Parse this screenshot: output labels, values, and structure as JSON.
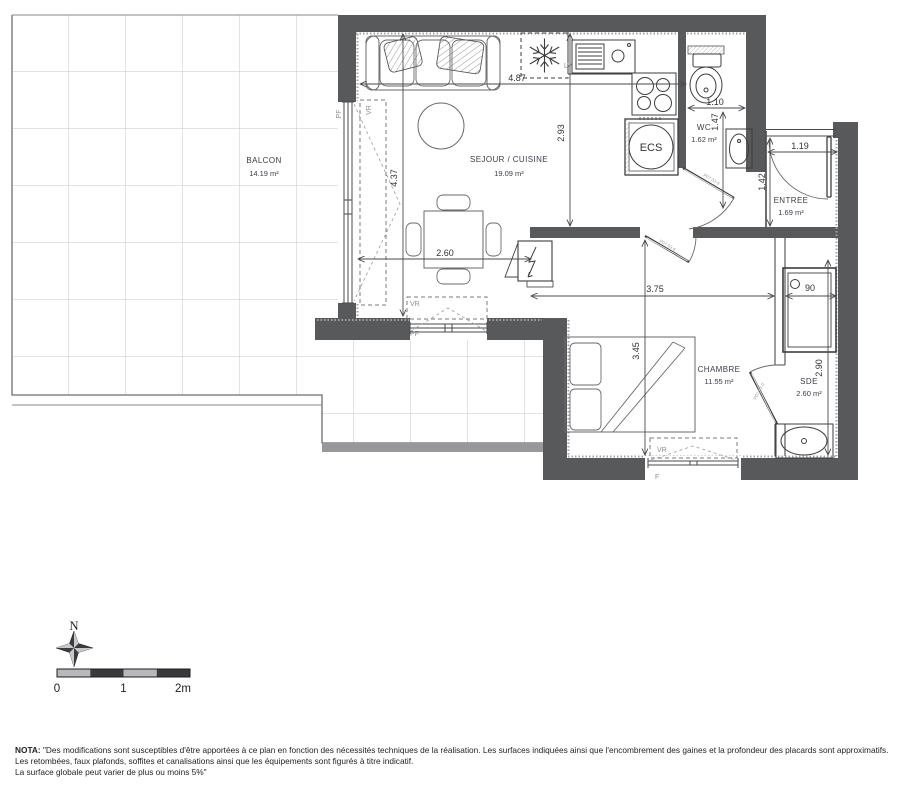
{
  "plan": {
    "rooms": [
      {
        "name": "BALCON",
        "area": "14.19 m²"
      },
      {
        "name": "SEJOUR / CUISINE",
        "area": "19.09 m²"
      },
      {
        "name": "WC",
        "area": "1.62 m²"
      },
      {
        "name": "ENTREE",
        "area": "1.69 m²"
      },
      {
        "name": "CHAMBRE",
        "area": "11.55 m²"
      },
      {
        "name": "SDE",
        "area": "2.60 m²"
      }
    ],
    "dimensions": {
      "kitchen_width": "4.87",
      "kitchen_depth": "2.93",
      "sejour_depth": "4.37",
      "sejour_width": "2.60",
      "wc_width": "1.10",
      "wc_depth": "1.47",
      "entree_width": "1.19",
      "entree_depth": "1.42",
      "chambre_width": "3.75",
      "chambre_depth": "3.45",
      "shower_width": "90",
      "sde_depth": "2.90"
    },
    "labels": {
      "water_heater": "ECS",
      "dishwasher": "LV",
      "window_left": "PF",
      "shutter_left": "VR",
      "window_south": "PF",
      "shutter_south": "VR",
      "window_chambre": "F",
      "shutter_chambre": "VR",
      "door_code": "P07.03 d"
    },
    "compass": {
      "north": "N"
    },
    "scale": {
      "t0": "0",
      "t1": "1",
      "t2": "2m"
    },
    "nota": {
      "title": "NOTA:",
      "line1": "\"Des modifications sont susceptibles d'être apportées à ce plan en fonction des nécessités techniques de la réalisation. Les surfaces indiquées ainsi que l'encombrement des gaines et la profondeur des placards sont approximatifs.",
      "line2": "Les retombées, faux plafonds, soffites et canalisations ainsi que les équipements sont figurés à titre indicatif.",
      "line3": "La surface globale peut varier de plus ou moins 5%\""
    },
    "colors": {
      "wall": "#58595b",
      "line": "#4a4a4c",
      "tile": "#c6c6c8",
      "muted": "#8e8e90"
    }
  }
}
